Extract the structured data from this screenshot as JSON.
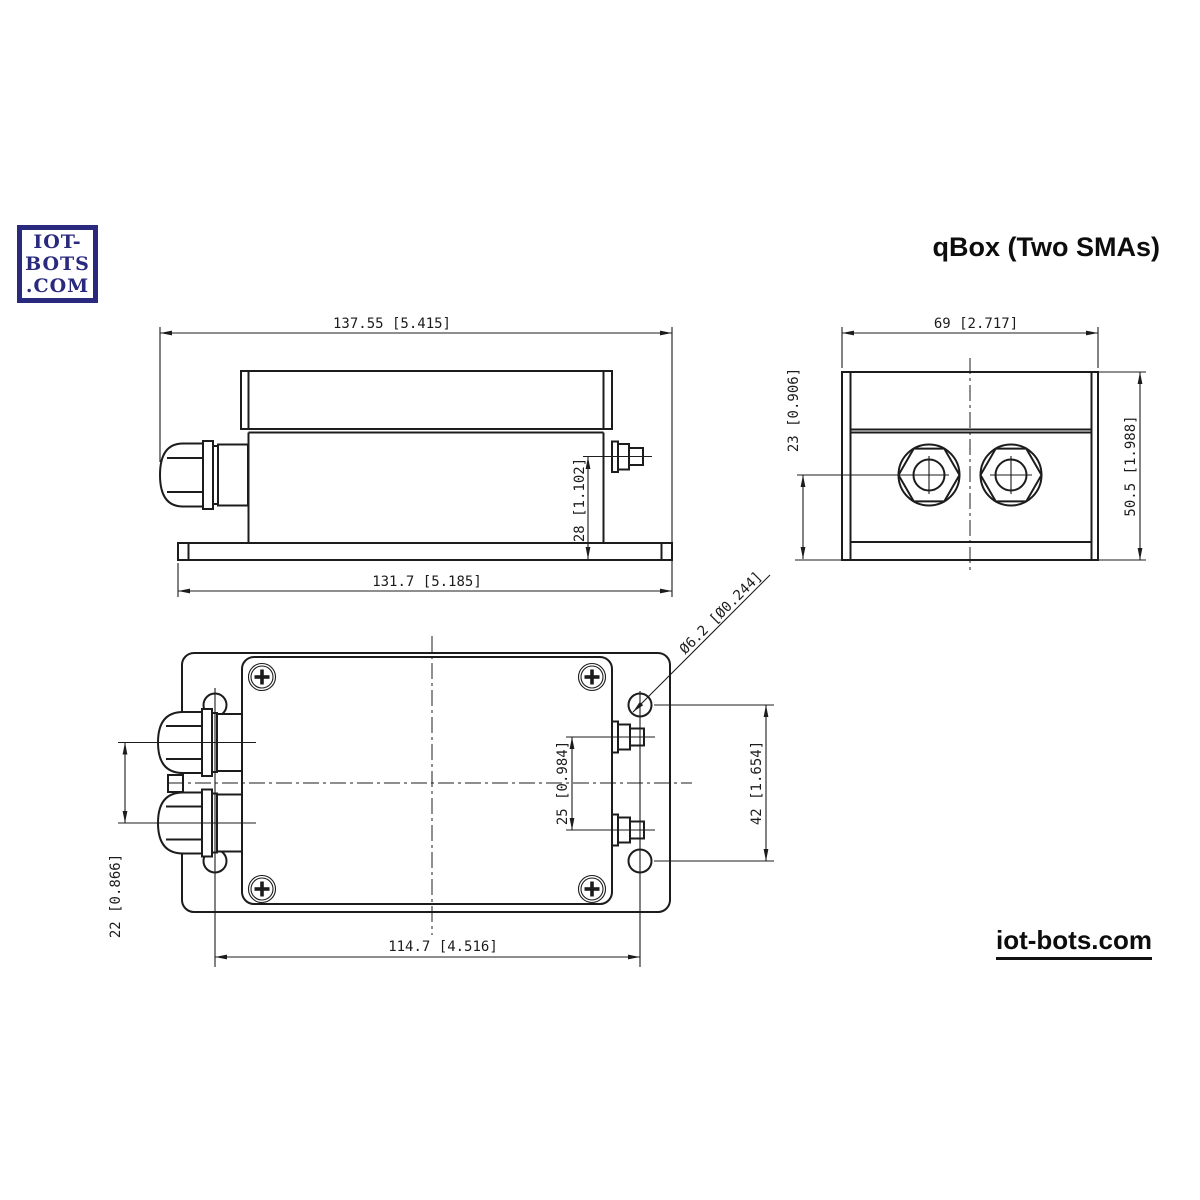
{
  "title": "qBox (Two SMAs)",
  "logo": {
    "lines": [
      "IOT-",
      "BOTS",
      ".COM"
    ],
    "color": "#29297d"
  },
  "footer": {
    "link": "iot-bots.com"
  },
  "drawing": {
    "ink": "#1c1c1c",
    "background": "#ffffff",
    "views": {
      "side": {
        "label": "side-view",
        "dims": {
          "overall_length": "137.55 [5.415]",
          "base_length": "131.7 [5.185]",
          "sma_height": "28 [1.102]"
        }
      },
      "end": {
        "label": "end-view",
        "dims": {
          "overall_width": "69 [2.717]",
          "gland_axis_height": "23 [0.906]",
          "overall_height": "50.5 [1.988]"
        }
      },
      "plan": {
        "label": "plan-view",
        "dims": {
          "gland_spacing": "22 [0.866]",
          "mount_hole_spacing_length": "114.7 [4.516]",
          "sma_spacing": "25 [0.984]",
          "mount_hole_spacing_width": "42 [1.654]",
          "mount_hole_diameter": "Ø6.2 [Ø0.244]"
        }
      }
    }
  }
}
